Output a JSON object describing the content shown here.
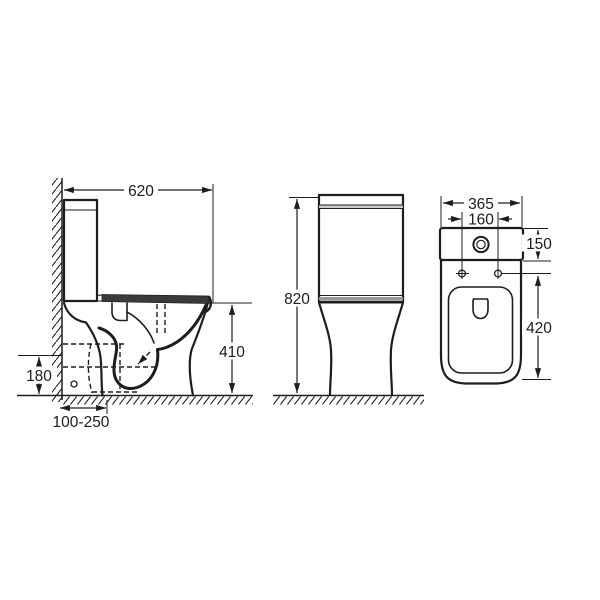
{
  "colors": {
    "line": "#1d1d1d",
    "seat_fill": "#3a3a3a",
    "background": "#ffffff"
  },
  "views": {
    "side": {
      "name": "side-elevation",
      "dims": {
        "overall_depth": "620",
        "seat_height": "410",
        "outlet_height": "180",
        "outlet_offset_range": "100-250"
      }
    },
    "front": {
      "name": "front-elevation",
      "dims": {
        "overall_height": "820"
      }
    },
    "top": {
      "name": "plan-view",
      "dims": {
        "overall_width": "365",
        "fixing_hole_spacing": "160",
        "cistern_depth": "150",
        "bowl_length": "420"
      }
    }
  }
}
